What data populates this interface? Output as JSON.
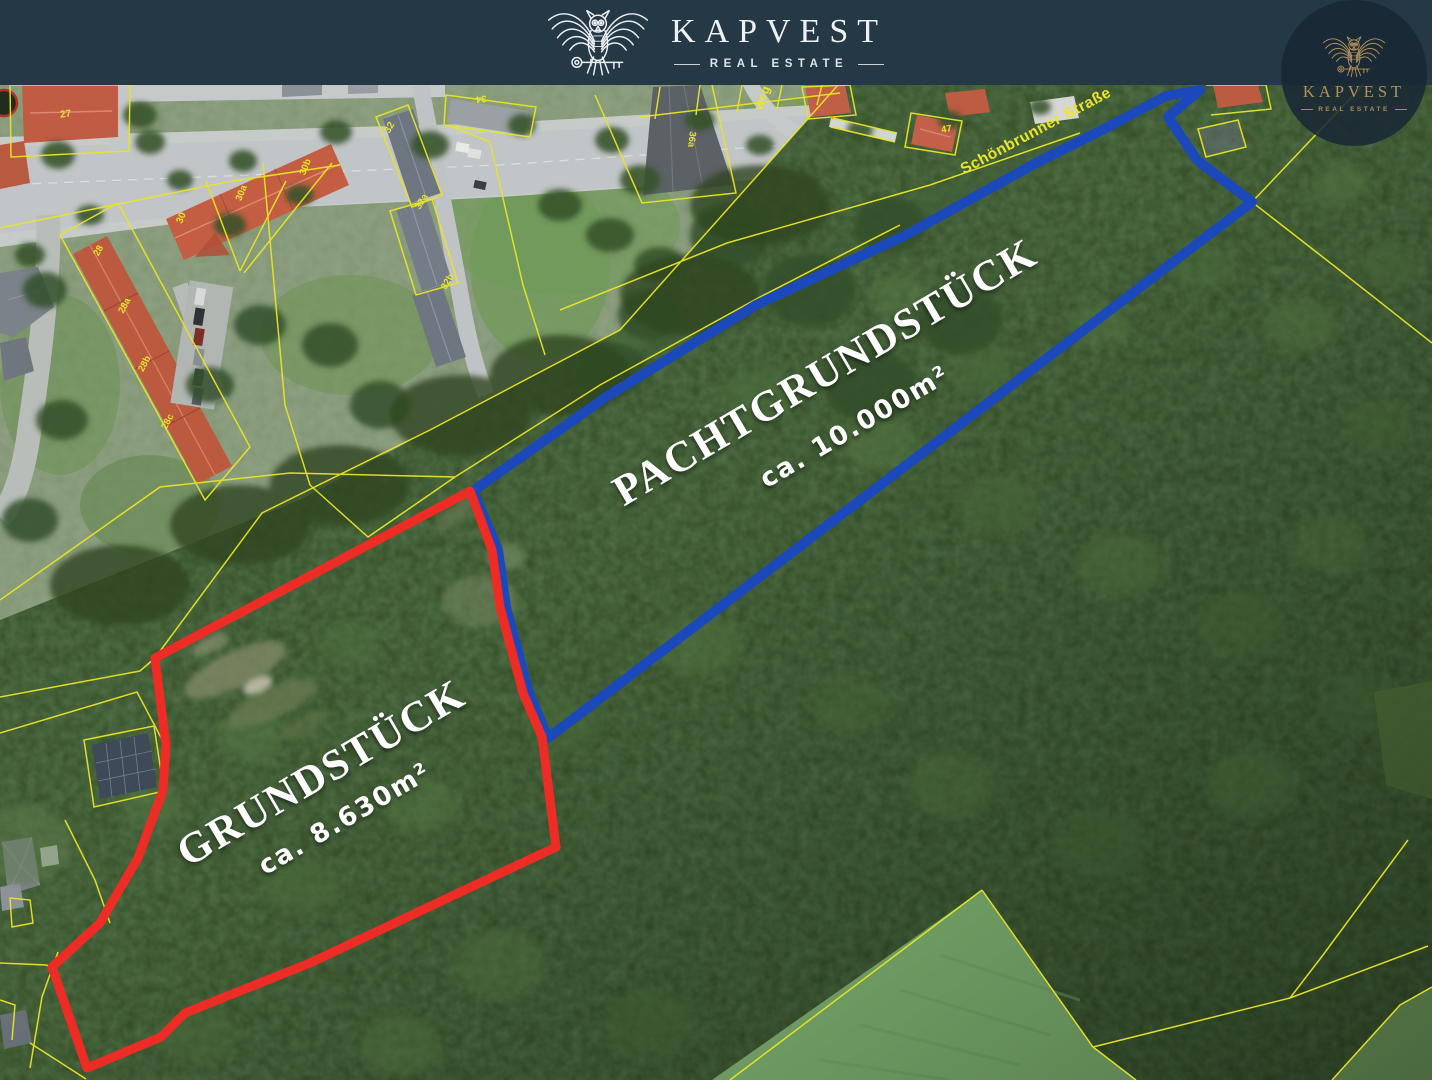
{
  "header": {
    "brand": "KAPVEST",
    "tagline": "REAL ESTATE"
  },
  "watermark": {
    "brand": "KAPVEST",
    "tagline": "REAL ESTATE"
  },
  "map": {
    "street_labels": [
      "Schönbrunner Straße",
      "weg"
    ],
    "parcel_labels": [
      "27",
      "28",
      "28a",
      "28b",
      "28c",
      "30",
      "30a",
      "30b",
      "32",
      "32a",
      "32b",
      "34",
      "36a",
      "47"
    ],
    "plots": [
      {
        "name": "GRUNDSTÜCK",
        "area": "ca. 8.630m²",
        "outline_color": "#ee2c26"
      },
      {
        "name": "PACHTGRUNDSTÜCK",
        "area": "ca. 10.000m²",
        "outline_color": "#1b49bb"
      }
    ],
    "colors": {
      "header_background": "#253845",
      "logo_gold": "#b2935a",
      "cadastral_yellow": "#e8e426",
      "plot_red": "#ee2c26",
      "plot_blue": "#1b49bb",
      "label_white": "#ffffff"
    }
  }
}
